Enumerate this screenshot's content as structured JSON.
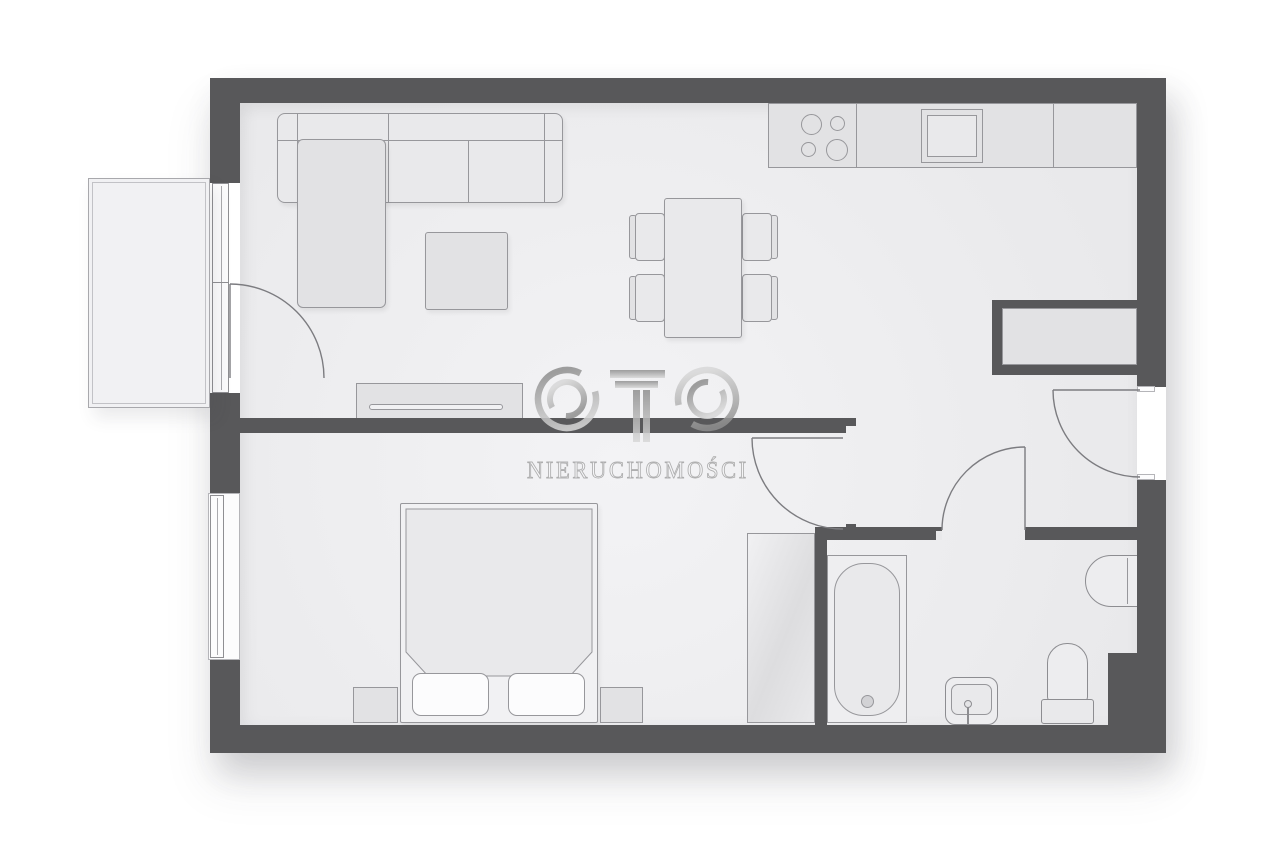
{
  "watermark": {
    "logo_text": "OTO",
    "subtitle": "NIERUCHOMOŚCI"
  },
  "palette": {
    "bg": "#ffffff",
    "wall": "#58585a",
    "line": "#97979b",
    "floor1": "#f3f3f5",
    "floor2": "#e9e9eb",
    "fill1": "#e9e9eb",
    "fill2": "#e2e2e4",
    "fill3": "#f1f1f3",
    "white": "#fcfcfd",
    "wmA": "#8f8f8f",
    "wmB": "#d8d8d8",
    "wmText": "#a3a3a3"
  },
  "elements": {
    "living_area": [
      "corner-sofa",
      "coffee-table",
      "tv-stand",
      "dining-table",
      "four-dining-chairs",
      "balcony-door"
    ],
    "kitchen": [
      "counter",
      "cooktop-4-burners",
      "kitchen-sink"
    ],
    "bedroom": [
      "double-bed",
      "two-pillows",
      "duvet",
      "two-nightstands",
      "wardrobe",
      "window"
    ],
    "bathroom": [
      "bathtub",
      "pedestal-washbasin",
      "toilet",
      "wall-washbasin",
      "bathroom-door"
    ],
    "hall": [
      "entrance-door",
      "built-in-niche",
      "bedroom-door"
    ],
    "outside": [
      "balcony"
    ]
  }
}
